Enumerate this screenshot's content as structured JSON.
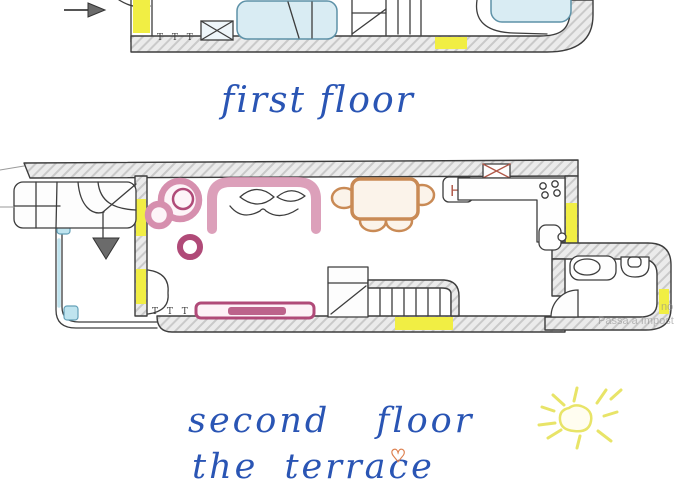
{
  "canvas": {
    "width": 700,
    "height": 500,
    "background": "#ffffff"
  },
  "palette": {
    "ink": "#3d3d3d",
    "wall_fill": "#ebebeb",
    "hatch_line": "#c9c9c9",
    "door_yellow": "#f1ee44",
    "water_blue": "#d9ecf3",
    "accent_blue": "#bfe4ef",
    "pink": "#d68fae",
    "pink_dark": "#b04a78",
    "tan": "#c98a55",
    "caption_blue": "#2a55b4",
    "sun_yellow": "#e8e468",
    "heart_orange": "#dd7f4d",
    "arrow_gray": "#6b6b6b",
    "watermark_gray": "#8f8f8f"
  },
  "captions": {
    "first_floor": "first floor",
    "second_floor": "second floor",
    "terrace": "the terrace"
  },
  "labels": {
    "radiator_first": "T T T",
    "radiator_second": "T T T",
    "stove_unit": "H"
  },
  "icons": {
    "heart": "♡"
  },
  "watermark": {
    "line1": "no",
    "line2": "Passa a Impost"
  },
  "plans": {
    "first_floor": {
      "caption": "first floor",
      "elements": [
        "entry-arrow",
        "entry-door",
        "radiator",
        "nightstand",
        "bed",
        "stairs",
        "bathtub",
        "door-marker"
      ]
    },
    "second_floor": {
      "caption": "second floor / the terrace",
      "rooms": [
        "entry-hall",
        "living-room",
        "dining-area",
        "kitchen",
        "bathroom"
      ],
      "elements": [
        "winder-staircase",
        "stairs-down-arrow",
        "double-door",
        "radiator",
        "armchair",
        "sofa",
        "pouf",
        "sideboard",
        "dining-table",
        "chairs",
        "highchair",
        "range-hood",
        "stove-burners",
        "kitchen-counter",
        "kitchen-sink",
        "washbasin",
        "toilet",
        "lower-staircase",
        "windows",
        "doors"
      ]
    }
  }
}
